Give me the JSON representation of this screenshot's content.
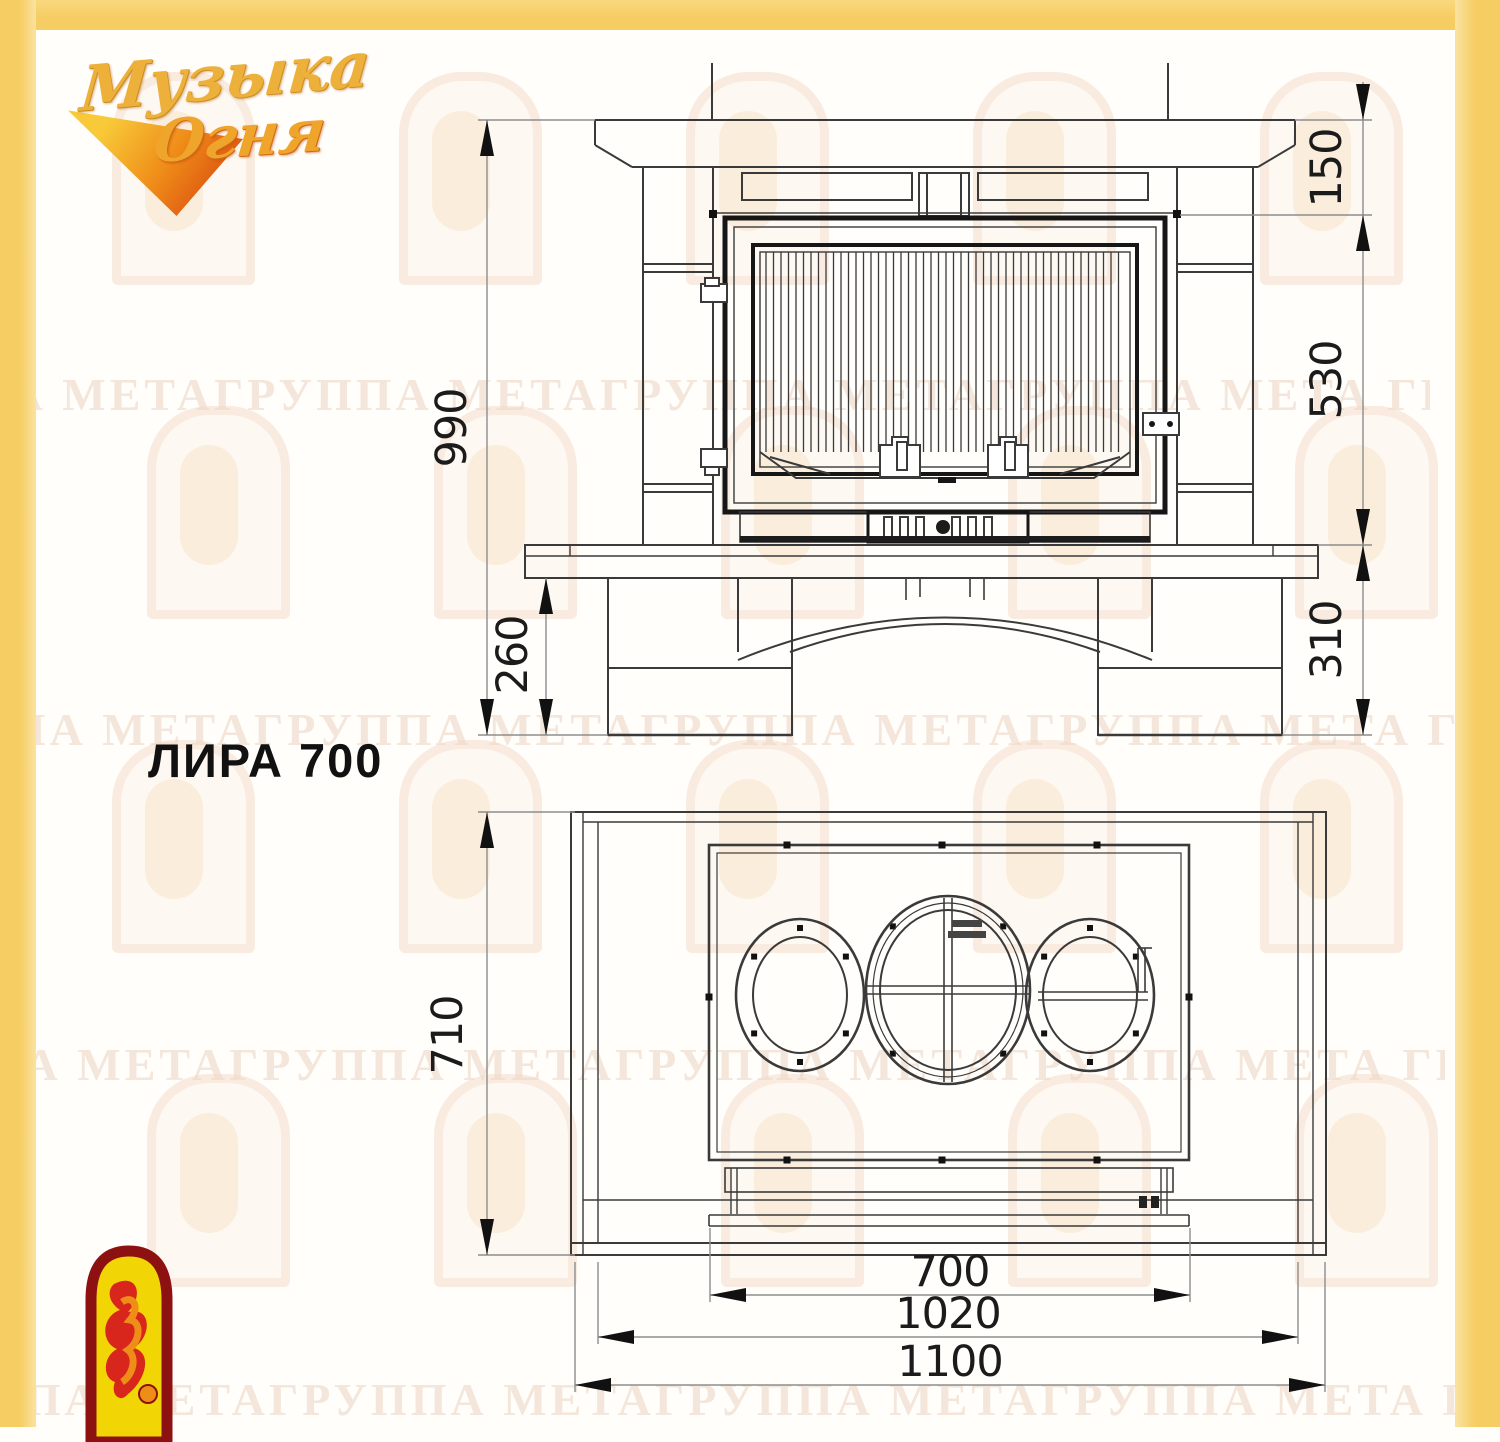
{
  "page": {
    "background": "#fffefb",
    "frame_color": "#f6cd63"
  },
  "logo": {
    "word1": "Музыка",
    "word2": "Огня"
  },
  "title": "ЛИРА 700",
  "watermark": {
    "text": "ППА МЕТАГРУППА МЕТАГРУППА МЕТАГРУППА МЕТА ГРУППА МЕТА"
  },
  "drawing": {
    "front_view": {
      "dims": {
        "total_height": "990",
        "plinth_height": "260",
        "top_band": "150",
        "firebox_height": "530",
        "base_height": "310"
      }
    },
    "top_view": {
      "dims": {
        "depth": "710",
        "opening_width": "700",
        "mid_width": "1020",
        "overall_width": "1100"
      }
    }
  }
}
